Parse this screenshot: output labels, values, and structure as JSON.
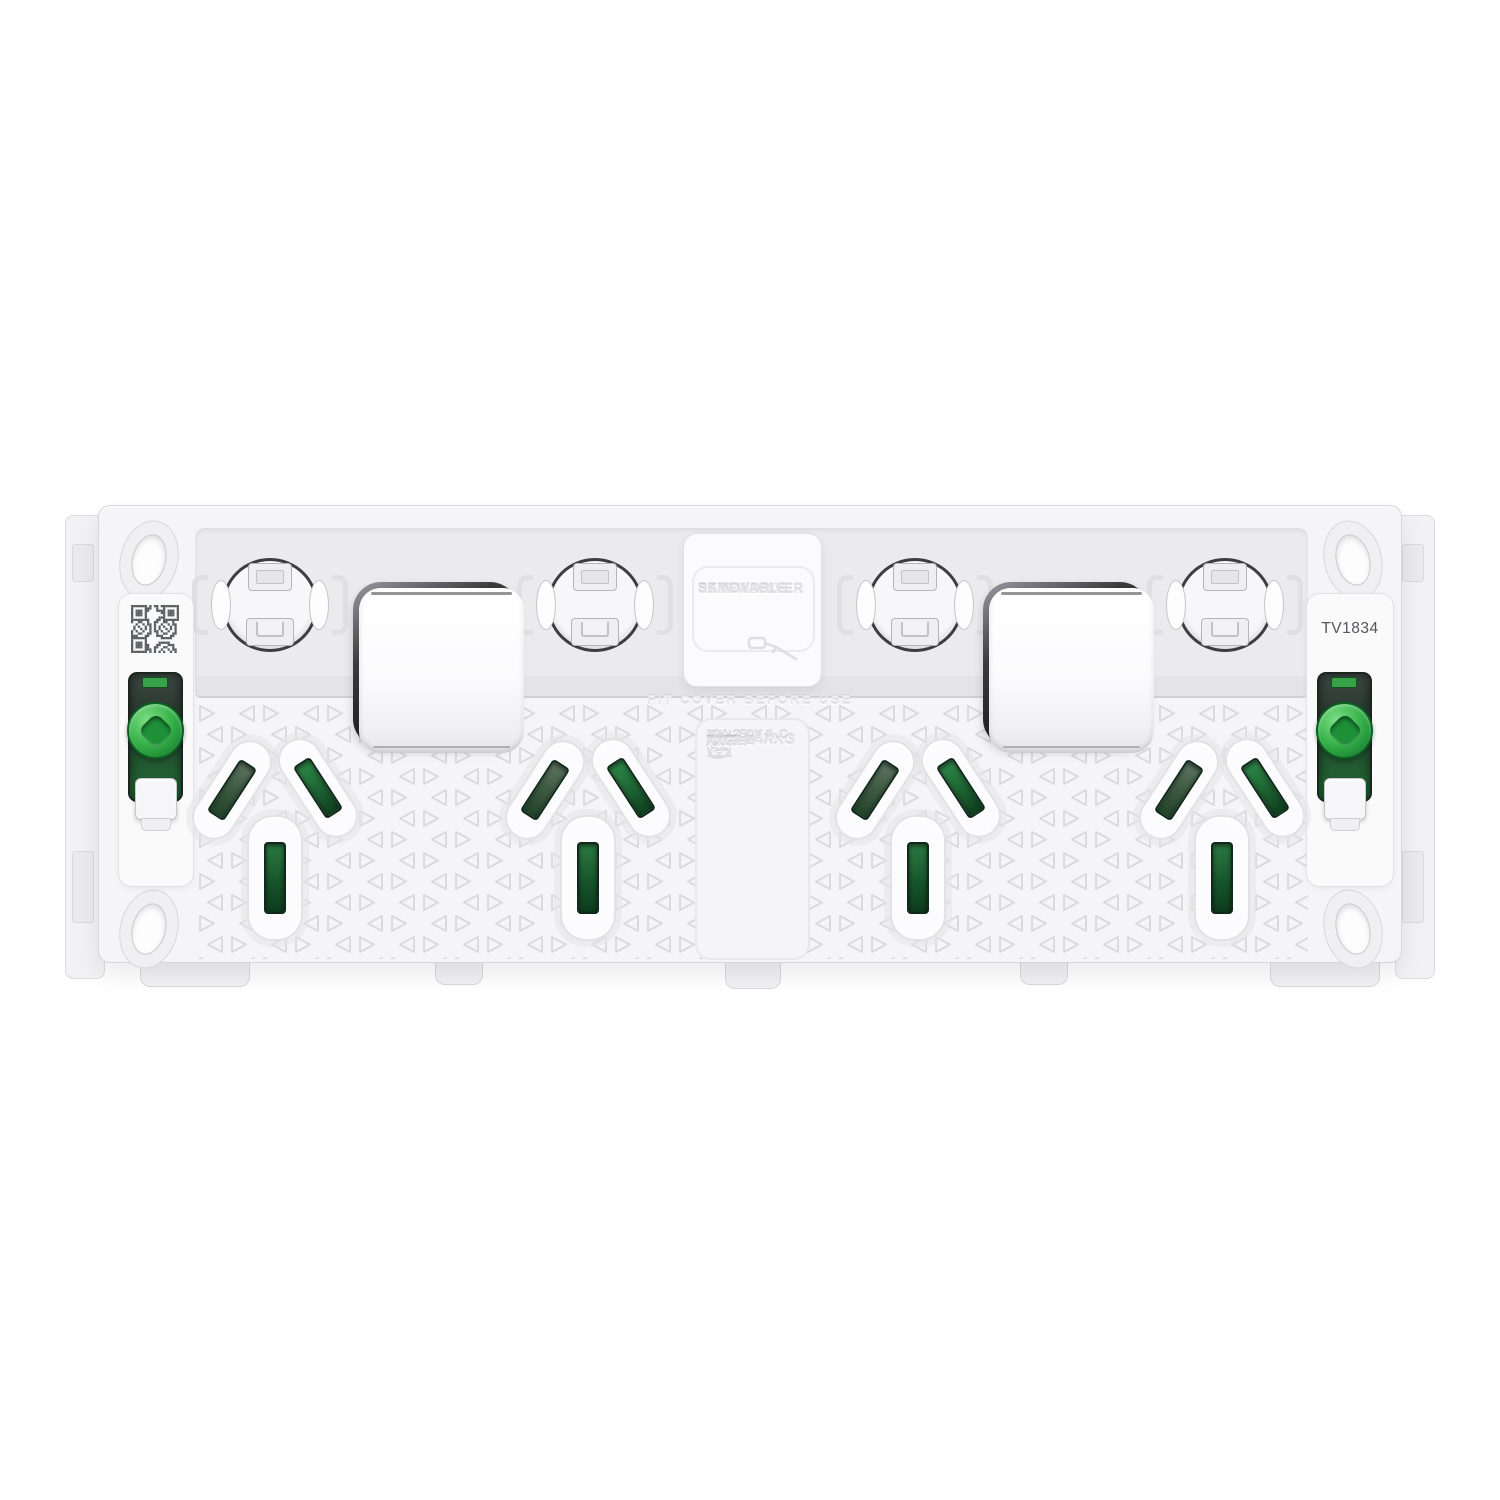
{
  "device": {
    "screwdriver_box": [
      "SCREWDRIVER",
      "REMOVABLE",
      "SKIN"
    ],
    "fit_cover_notice": "FIT COVER BEFORE USE",
    "spec_label": {
      "brand_prefix": "II",
      "brand": "CLIPSAL",
      "model": "P3015/4XXG",
      "rating": "10A 250V A.C.",
      "pole_line1": "SIMPLE",
      "pole_line2": "POLE",
      "diameter": "Ø57",
      "depth": "<46>",
      "pdl_mark": "PDL",
      "part_line1": "P395H4",
      "part_line2": "XXG"
    },
    "batch_code": "TV1834",
    "colors": {
      "slot_green_dark": "#1b5e30",
      "slot_green_gray": "#4a6750",
      "screw_green": "#3cb54e",
      "body_white": "#f5f5f7",
      "emboss_text": "#e2e2e6"
    },
    "icons": {
      "qr": "qr-code",
      "rcm": "rcm-compliance-triangle",
      "pdl": "pdl-logo-roundel",
      "plug": "plug-depth-icon",
      "screwdriver": "screwdriver-icon"
    }
  }
}
